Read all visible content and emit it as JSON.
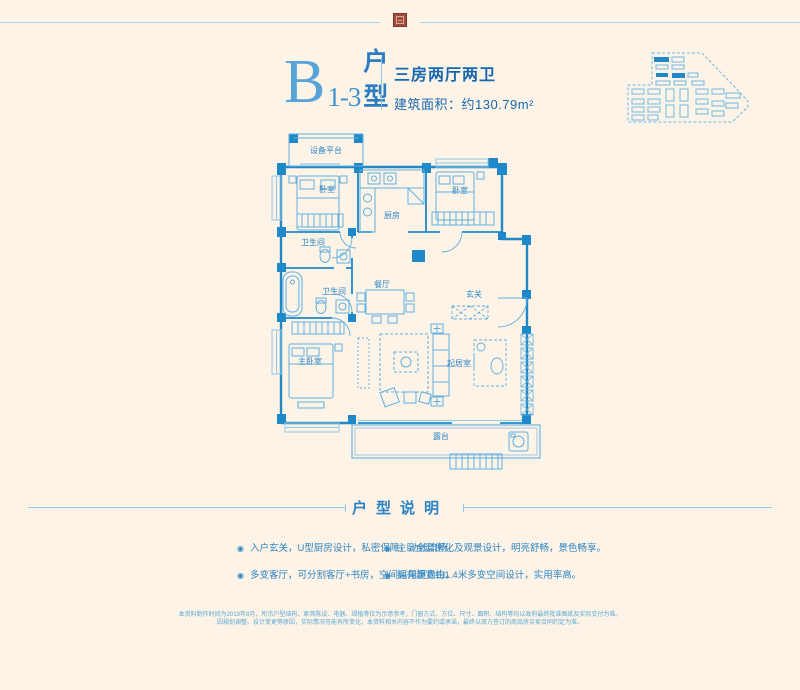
{
  "colors": {
    "background": "#fdf3e6",
    "accent_blue": "#2e86c8",
    "wall_blue": "#1e88c9",
    "furniture_blue": "#5fafe0",
    "seal_red": "#a34b3e"
  },
  "header": {
    "unit_letter": "B",
    "unit_number": "1-3",
    "unit_word_top": "户",
    "unit_word_bottom": "型",
    "layout_summary": "三房两厅两卫",
    "area_text": "建筑面积：约130.79m²"
  },
  "floor_plan": {
    "rooms": [
      {
        "name": "设备平台"
      },
      {
        "name": "卧室"
      },
      {
        "name": "厨房"
      },
      {
        "name": "卧室"
      },
      {
        "name": "卫生间"
      },
      {
        "name": "卫生间"
      },
      {
        "name": "餐厅"
      },
      {
        "name": "玄关"
      },
      {
        "name": "主卧室"
      },
      {
        "name": "起居室"
      },
      {
        "name": "露台"
      }
    ]
  },
  "description": {
    "title": "户型说明",
    "bullet_icon": "◉",
    "bullets": [
      "入户玄关，U型厨房设计，私密保障，动线流畅。",
      "主卧全套房化及观景设计，明亮舒畅，景色畅享。",
      "多变客厅，可分割客厅+书房，空间运用更自由。",
      "拥有超宽约1.4米多变空间设计，实用率高。"
    ]
  },
  "disclaimer": {
    "line1": "本资料制作时间为2019年8月，所示户型结构、家具陈设、电器、绿植等仅为示意参考，门窗方式、方位、尺寸、面积、结构等均以政府最终批准图纸及实际交付为准。",
    "line2": "因规划调整、设计变更等原因，实际情况可能有所变化，本资料相关内容不作为要约或承诺，最终以双方签订的商品房买卖合同约定为准。"
  }
}
